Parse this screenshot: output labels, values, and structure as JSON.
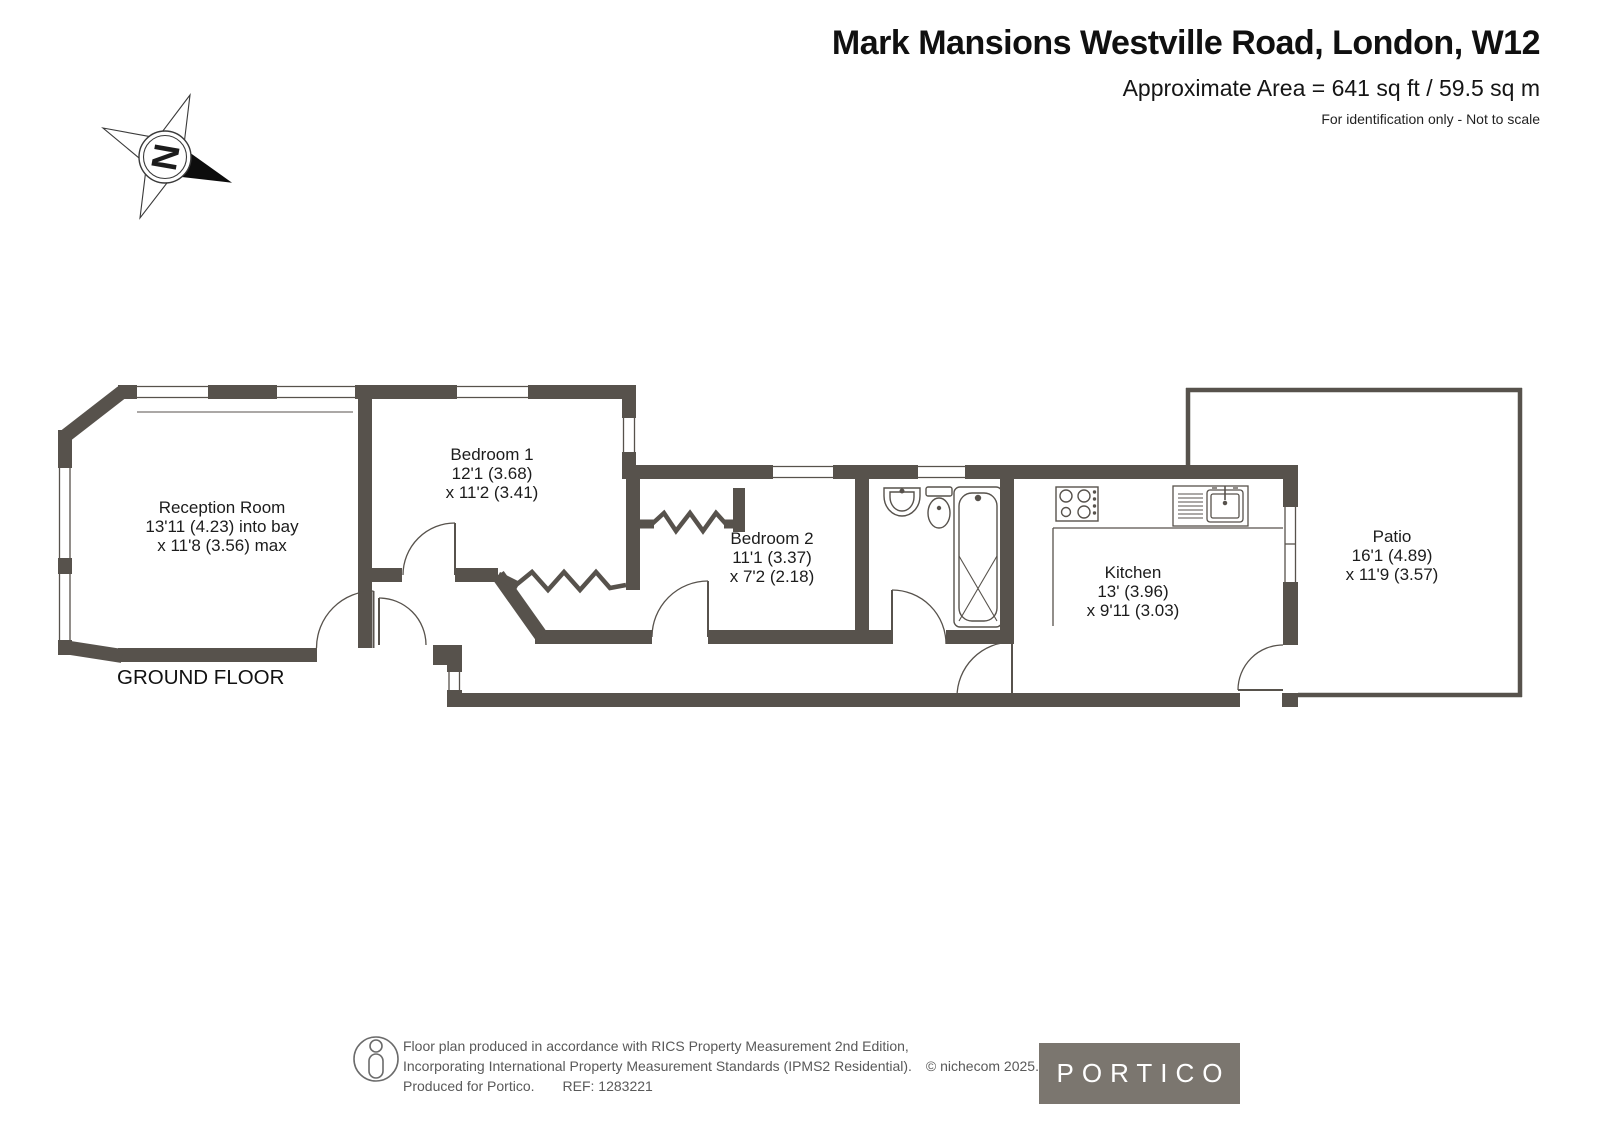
{
  "header": {
    "title": "Mark Mansions Westville Road, London, W12",
    "area_line": "Approximate Area = 641 sq ft / 59.5 sq m",
    "disclaimer": "For identification only - Not to scale"
  },
  "compass": {
    "north_label": "N"
  },
  "plan": {
    "floor_label": "GROUND FLOOR",
    "rooms": {
      "reception": {
        "name": "Reception Room",
        "dim_line1": "13'11 (4.23) into bay",
        "dim_line2": "x 11'8 (3.56) max"
      },
      "bedroom1": {
        "name": "Bedroom 1",
        "dim_line1": "12'1 (3.68)",
        "dim_line2": "x 11'2 (3.41)"
      },
      "bedroom2": {
        "name": "Bedroom 2",
        "dim_line1": "11'1 (3.37)",
        "dim_line2": "x 7'2 (2.18)"
      },
      "kitchen": {
        "name": "Kitchen",
        "dim_line1": "13' (3.96)",
        "dim_line2": "x 9'11 (3.03)"
      },
      "patio": {
        "name": "Patio",
        "dim_line1": "16'1 (4.89)",
        "dim_line2": "x 11'9 (3.57)"
      }
    }
  },
  "footer": {
    "line1": "Floor plan produced in accordance with RICS Property Measurement 2nd Edition,",
    "line2": "Incorporating International Property Measurement Standards (IPMS2 Residential).",
    "copyright": "© nichecom 2025.",
    "produced": "Produced for Portico.",
    "ref": "REF:  1283221",
    "brand": "PORTICO"
  },
  "colors": {
    "wall": "#57524C",
    "brand_bg": "#7B766F",
    "footer_text": "#595959"
  }
}
